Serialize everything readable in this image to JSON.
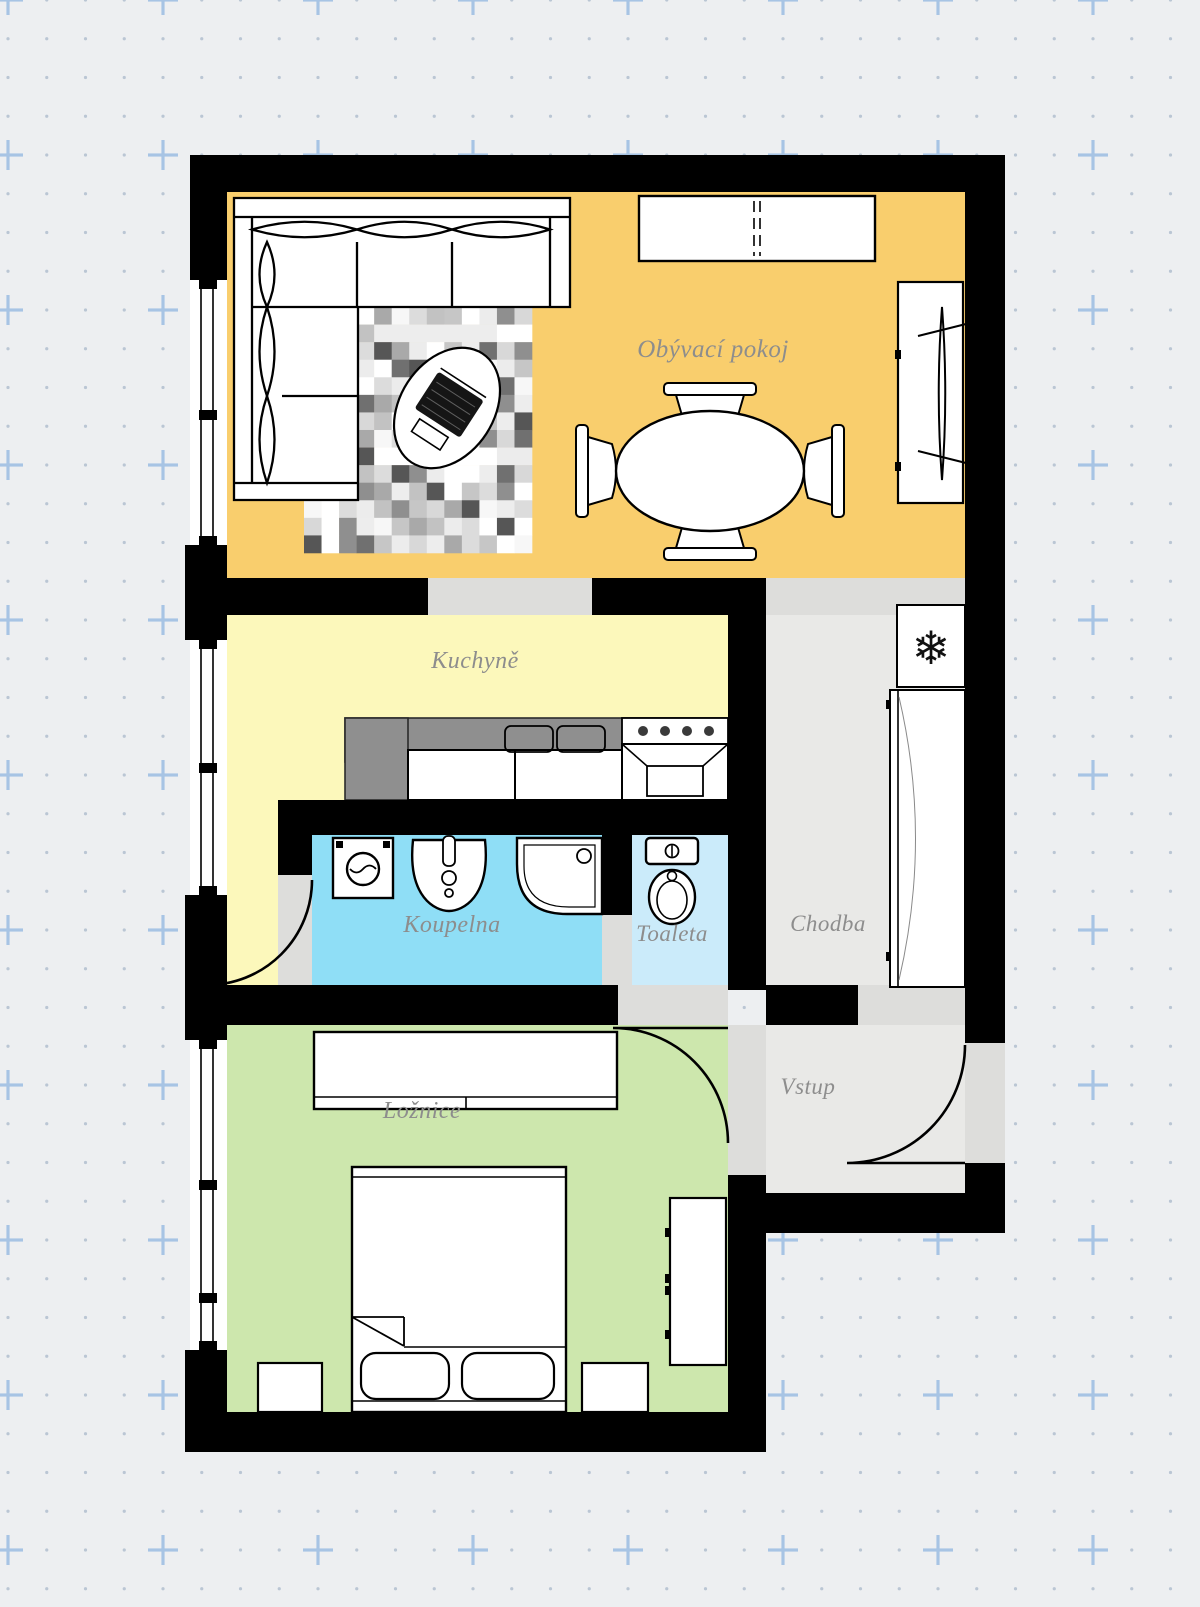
{
  "plan": {
    "background_color": "#EDEFF1",
    "wall_color": "#000000",
    "threshold_color": "#DDDDDB",
    "label_color": "#8D8D8D",
    "grid": {
      "dot_color": "#BAC6D4",
      "cross_color": "#A7C4E4"
    },
    "rooms": [
      {
        "id": "living-room",
        "label": "Obývací pokoj",
        "color": "#F9CE6D"
      },
      {
        "id": "kitchen",
        "label": "Kuchyně",
        "color": "#FCF8BB"
      },
      {
        "id": "bathroom",
        "label": "Koupelna",
        "color": "#8FDEF6"
      },
      {
        "id": "toilet",
        "label": "Toaleta",
        "color": "#CBEBFA"
      },
      {
        "id": "hallway",
        "label": "Chodba",
        "color": "#E9E9E7"
      },
      {
        "id": "entry",
        "label": "Vstup",
        "color": "#E9E9E7"
      },
      {
        "id": "bedroom",
        "label": "Ložnice",
        "color": "#CDE7AD"
      }
    ],
    "icons": {
      "snowflake": "❄"
    }
  }
}
